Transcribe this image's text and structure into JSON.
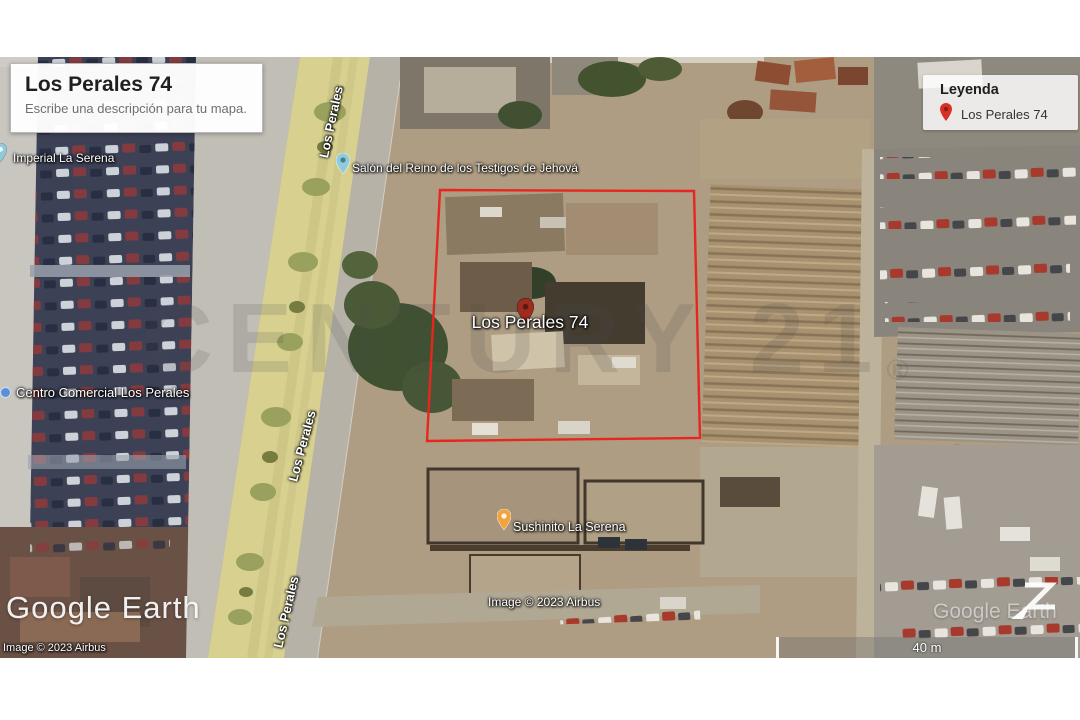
{
  "title_card": {
    "title": "Los Perales 74",
    "subtitle": "Escribe una descripción para tu mapa."
  },
  "legend": {
    "title": "Leyenda",
    "items": [
      {
        "icon": "red-pin",
        "label": "Los Perales 74"
      }
    ]
  },
  "property": {
    "label": "Los Perales 74",
    "outline_color": "#e8251f",
    "pin_color": "#a02c20"
  },
  "map_labels": {
    "imperial": "Imperial La Serena",
    "salon": "Salón del Reino de los Testigos de Jehová",
    "centro": "Centro Comercial Los Perales",
    "sushinito": "Sushinito La Serena",
    "street": "Los Perales"
  },
  "watermark": {
    "text": "CENTURY 21",
    "registered": "®"
  },
  "branding": {
    "logo": "Google Earth",
    "attribution": "Image © 2023 Airbus"
  },
  "scale_bar": {
    "label": "40 m"
  },
  "colors": {
    "legend_pin": "#d93025",
    "salon_pin": "#8ecbdb",
    "sushinito_pin": "#f2a33c",
    "median_strip": "#d7d08f",
    "parking_lot": "#3c4156"
  }
}
